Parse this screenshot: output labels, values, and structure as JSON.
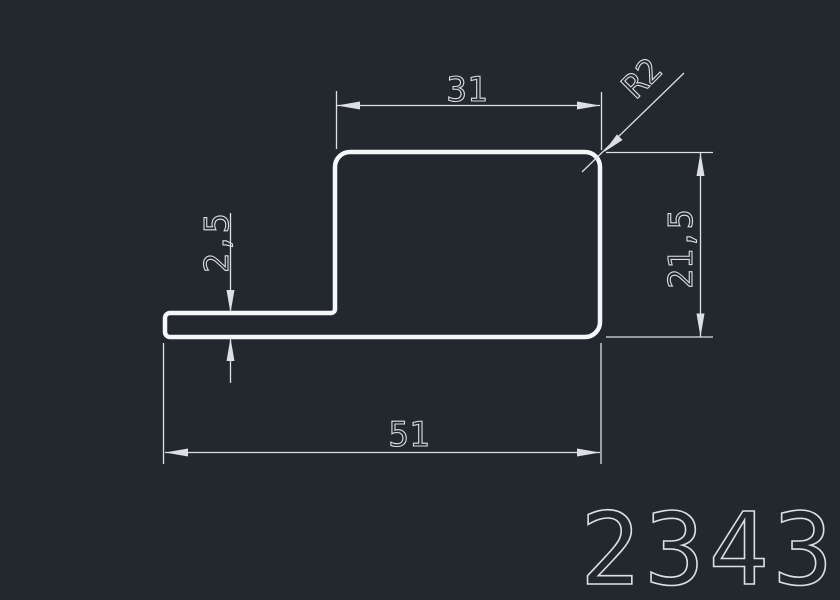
{
  "drawing": {
    "type": "profile-cross-section",
    "part_number": "2343",
    "dimensions": {
      "top_width": "31",
      "corner_radius": "R2",
      "flange_thickness": "2,5",
      "side_height": "21,5",
      "overall_width": "51"
    },
    "colors": {
      "background": "#23282e",
      "profile": "#f4f6f8",
      "dimension": "#dcdfe3"
    }
  }
}
